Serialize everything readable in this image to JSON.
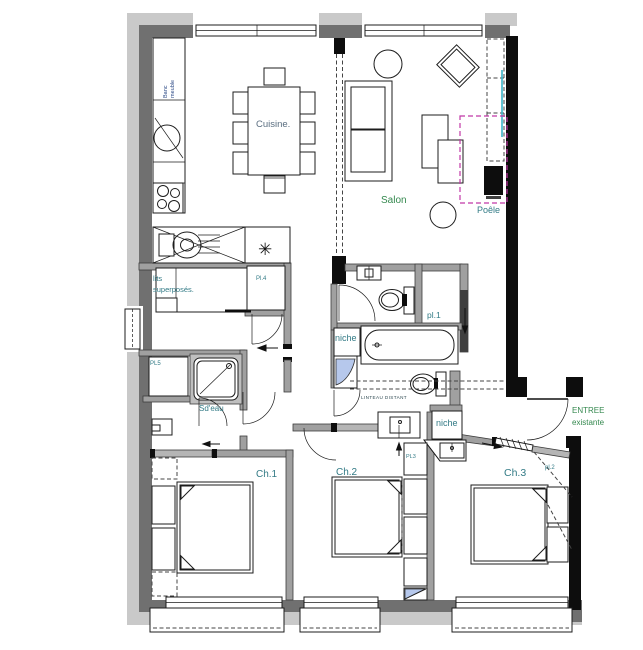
{
  "meta": {
    "title": "Apartment floor plan",
    "width": 643,
    "height": 650
  },
  "colors": {
    "paper": "#ffffff",
    "line": "#1c1c1c",
    "wall_light": "#c9c9c9",
    "wall_mid": "#707070",
    "wall_black": "#0d0d0d",
    "interior_wall": "#a0a0a0",
    "door_slab": "#b5b5b5",
    "label_teal": "#337b86",
    "label_green": "#35894f",
    "label_navy": "#2c4a86",
    "label_bluegray": "#5a6e80",
    "annotation_dark": "#2f4a52",
    "accent_magenta": "#c138a6",
    "accent_cyan": "#3ab5c9",
    "accent_blue": "#b6c8ec"
  },
  "labels": {
    "banc": {
      "line1": "Banc",
      "line2": "meuble"
    },
    "cuisine": "Cuisine.",
    "salon": "Salon",
    "poele": "Poêle",
    "lits": {
      "line1": "lits",
      "line2": "superposés."
    },
    "pl4": "Pl.4",
    "pl5": "PL5",
    "sdeau": "Sd'eau",
    "pl1": "pl.1",
    "niche_bath": "niche",
    "linteau": "LINTEAU DISTANT",
    "niche_entry": "niche",
    "entree": {
      "line1": "ENTREE",
      "line2": "existante"
    },
    "ch1": "Ch.1",
    "ch2": "Ch.2",
    "ch3": "Ch.3",
    "pl3": "PL3",
    "pl2": "pl.2",
    "water_heater_symbol": "✳"
  }
}
